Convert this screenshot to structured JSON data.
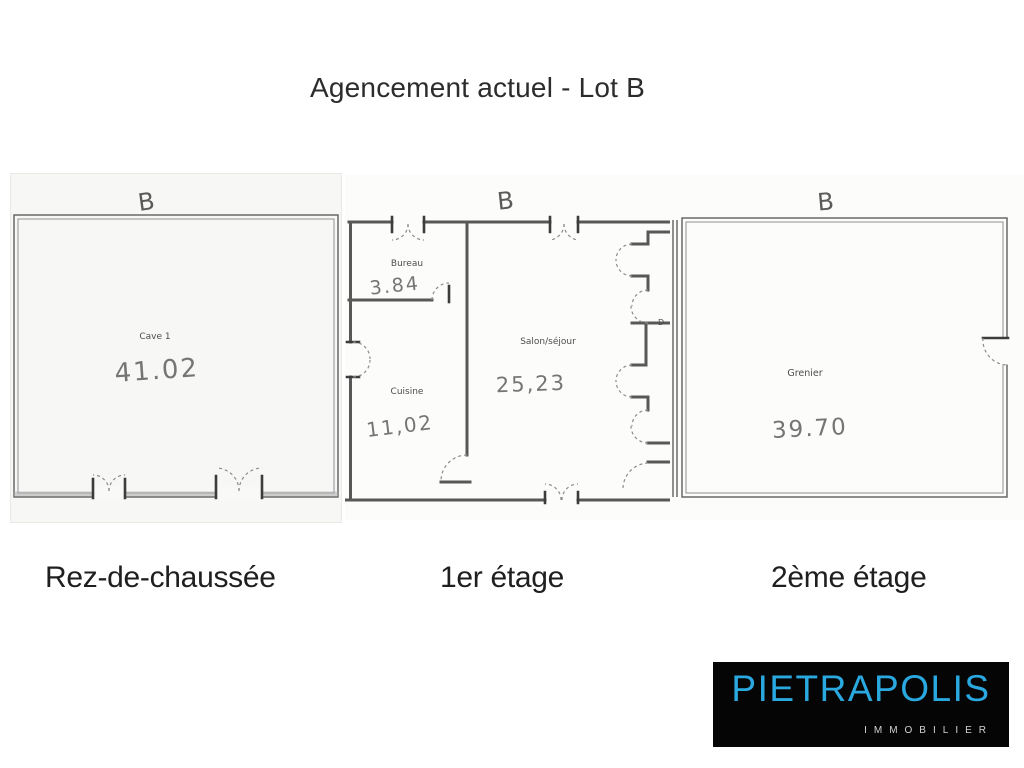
{
  "page": {
    "title": "Agencement actuel - Lot B"
  },
  "floors": [
    {
      "label": "Rez-de-chaussée",
      "plan_letter": "B",
      "rooms": [
        {
          "name": "Cave 1",
          "area": "41.02"
        }
      ]
    },
    {
      "label": "1er étage",
      "plan_letter": "B",
      "door_label": "D",
      "rooms": [
        {
          "name": "Bureau",
          "area": "3.84"
        },
        {
          "name": "Cuisine",
          "area": "11,02"
        },
        {
          "name": "Salon/séjour",
          "area": "25,23"
        }
      ]
    },
    {
      "label": "2ème étage",
      "plan_letter": "B",
      "rooms": [
        {
          "name": "Grenier",
          "area": "39.70"
        }
      ]
    }
  ],
  "logo": {
    "brand": "PIETRAPOLIS",
    "tagline": "IMMOBILIER",
    "brand_color": "#2aa9e1",
    "background": "#050505"
  }
}
